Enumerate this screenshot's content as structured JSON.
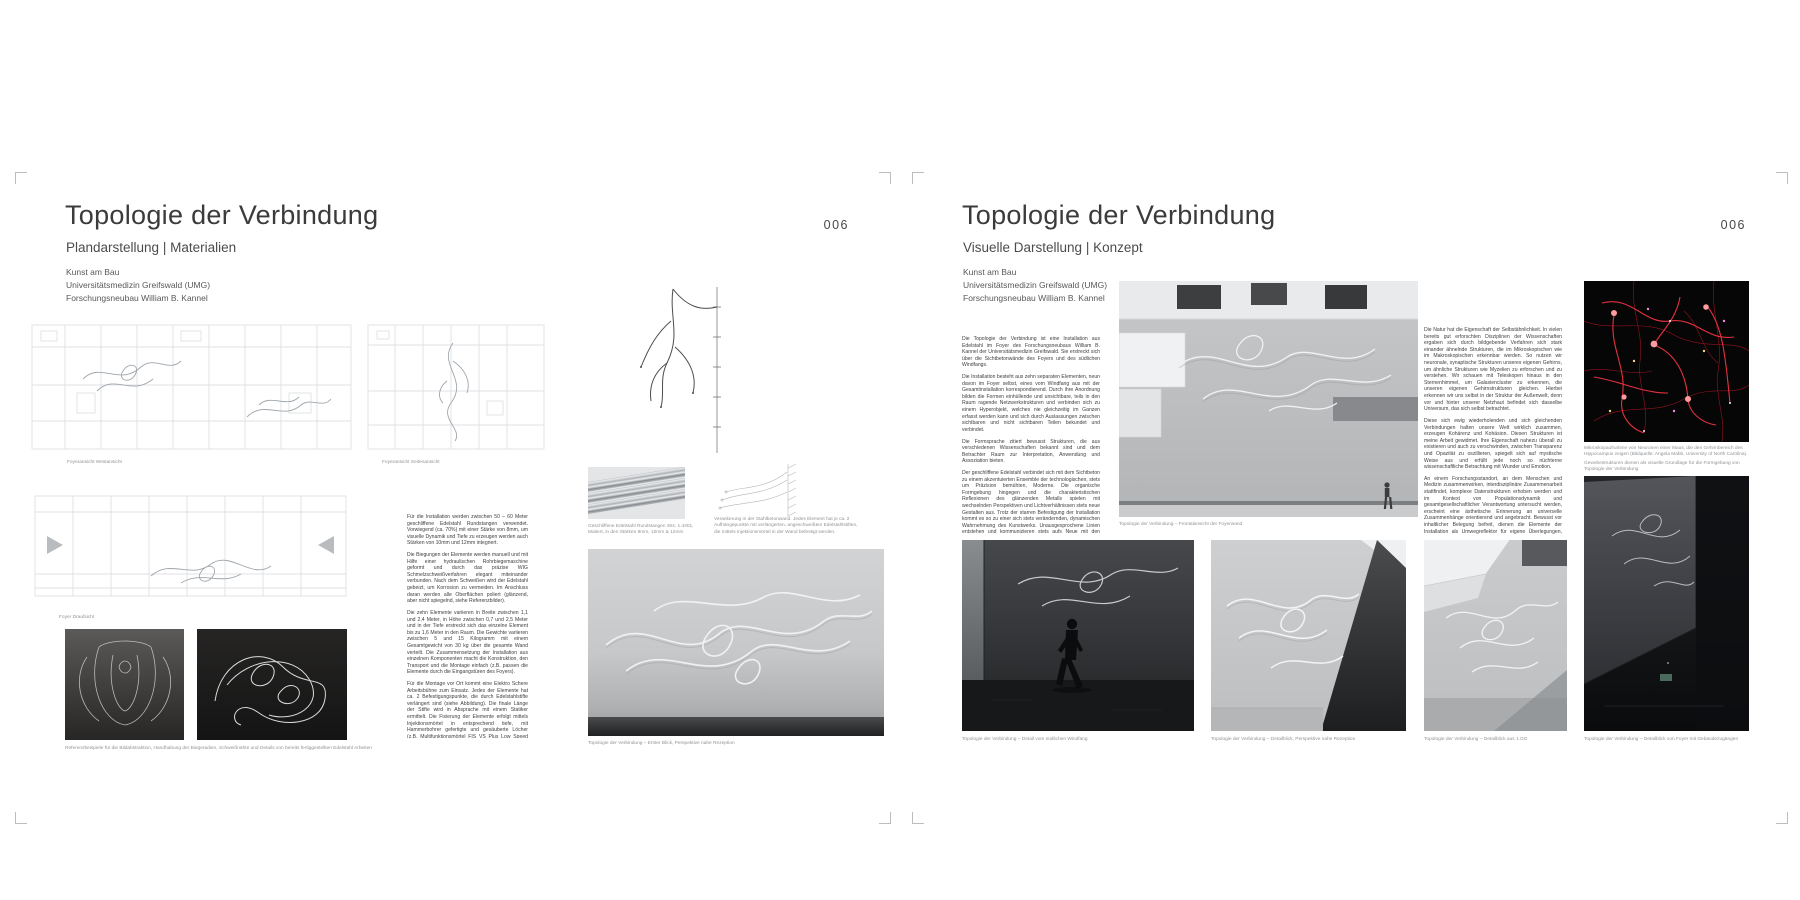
{
  "colors": {
    "paper": "#ffffff",
    "ink": "#3c3c3c",
    "caption_gray": "#909396",
    "neuron_red": "#ef3442"
  },
  "left_page": {
    "page_number": "006",
    "title": "Topologie der Verbindung",
    "subtitle": "Plandarstellung | Materialien",
    "credits": [
      "Kunst am Bau",
      "Universitätsmedizin Greifswald (UMG)",
      "Forschungsneubau William B. Kannel"
    ],
    "body": [
      "Für die Installation werden zwischen 50 – 60 Meter geschliffene Edelstahl Rundstangen verwendet. Vorwiegend (ca. 70%) mit einer Stärke von 8mm, um visuelle Dynamik und Tiefe zu erzeugen werden auch Stärken von 10mm und 12mm integriert.",
      "Die Biegungen der Elemente werden manuell und mit Hilfe einer hydraulischen Rohrbiegemaschine geformt und durch das präzise WIG Schmelzschweißverfahren elegant miteinander verbunden. Nach dem Schweißen wird der Edelstahl gebeizt, um Korrosion zu vermeiden. Im Anschluss daran werden alle Oberflächen poliert (glänzend, aber nicht spiegelnd, siehe Referenzbilder).",
      "Die zehn Elemente variieren in Breite zwischen 1,1 und 2,4 Meter, in Höhe zwischen 0,7 und 2,5 Meter und in der Tiefe erstreckt sich das einzelne Element bis zu 1,6 Meter in den Raum. Die Gewichte variieren zwischen 5 und 15 Kilogramm mit einem Gesamtgewicht von 30 kg über die gesamte Wand verteilt. Die Zusammensetzung der Installation aus einzelnen Komponenten macht die Konstruktion, den Transport und die Montage einfach (z.B. passen die Elemente durch die Eingangstüren des Foyers).",
      "Für die Montage vor Ort kommt eine Elektro Schere Arbeitsbühne zum Einsatz. Jedes der Elemente hat ca. 2 Befestigungspunkte, die durch Edelstahlstifte verlängert sind (siehe Abbildung). Die finale Länge der Stifte wird in Absprache mit einem Statiker ermittelt. Die Fixierung der Elemente erfolgt mittels Injektionsmörtel in entsprechend tiefe, mit Hammerbohrer gefertigte und gesäuberte Löcher (z.B. Multifunktionsmörtel FIS VS Plus Low Speed oder UPM 33).",
      "Edelstahl hat eine lange Lebensdauer und stellt keine Gefahr für Mensch und Umwelt dar. Eventuelle Folgekosten sollten nur aus gelegentlicher Grundreinigung entstehen. Eine gezielte Lichtinszenierung wäre denkbar, ist aber nicht zwingend erforderlich."
    ],
    "captions": {
      "plan_west": "Foyeransicht Westansicht",
      "plan_side": "Foyeransicht Seitenansicht",
      "plan_top": "Foyer Draufsicht",
      "rods": "Geschliffene Edelstahl Rundstangen 304, 1.4301, Matiert, in den Stärken 8mm, 10mm & 12mm",
      "anchor": "Verankerung in der Stahlbetonwand. Jedes Element hat je ca. 2 Aufhängepunkte mit verlängerten, angeschweißten Edelstahlstiften, die mittels Injektionsmörtel in der Wand befestigt werden.",
      "reference": "Referenzbeispiele für die Bildabstraktion, Handhabung der Biegeradien, Schweißnähte und Details von bereits fertiggestellten Edelstahl Arbeiten",
      "hero": "Topologie der Verbindung – Erster Blick, Perspektive nahe Rezeption"
    }
  },
  "right_page": {
    "page_number": "006",
    "title": "Topologie der Verbindung",
    "subtitle": "Visuelle Darstellung | Konzept",
    "credits": [
      "Kunst am Bau",
      "Universitätsmedizin Greifswald (UMG)",
      "Forschungsneubau William B. Kannel"
    ],
    "col1": [
      "Die Topologie der Verbindung ist eine Installation aus Edelstahl im Foyer des Forschungsneubaus William B. Kannel der Universitätsmedizin Greifswald. Sie erstreckt sich über die Sichtbetonwände des Foyers und des südlichen Windfangs.",
      "Die Installation besteht aus zehn separaten Elementen, neun davon im Foyer selbst, eines vom Windfang aus mit der Gesamtinstallation korrespondierend. Durch ihre Anordnung bilden die Formen einhüllende und unsichtbare, teils in den Raum ragende Netzwerkstrukturen und verbinden sich zu einem Hyperobjekt, welches nie gleichzeitig im Ganzen erfasst werden kann und sich durch Auslassungen zwischen sichtbaren und nicht sichtbaren Teilen bekundet und verbindet.",
      "Die Formsprache zitiert bewusst Strukturen, die aus verschiedenen Wissenschaften bekannt sind und dem Betrachter Raum zur Interpretation, Anwendung und Assoziation bieten.",
      "Der geschliffene Edelstahl verbindet sich mit dem Sichtbeton zu einem akzentuierten Ensemble der technologischen, stets um Präzision bemühten, Moderne. Die organische Formgebung hingegen und die charakteristischen Reflexionen des glänzenden Metalls spielen mit wechselnden Perspektiven und Lichtverhältnissen stets neue Gestalten aus. Trotz der starren Befestigung der Installation kommt es so zu einer sich stets verändernden, dynamischen Wahrnehmung des Kunstwerks. Unausgesprochene Linien entstehen und kommunizieren stets aufs Neue mit den wellenförmigen, zirkulären und triangulären Elementen der Installation, je nach Position im Raum."
    ],
    "col2": [
      "Die Natur hat die Eigenschaft der Selbstähnlichkeit. In vielen bereits gut erforschten Disziplinen der Wissenschaften ergaben sich durch bildgebende Verfahren sich stark einander ähnelnde Strukturen, die im Mikroskopischen wie im Makroskopischen erkennbar werden. So nutzen wir neuronale, synaptische Strukturen unseres eigenen Gehirns, um ähnliche Strukturen wie Myzelien zu erforschen und zu verstehen. Wir schauen mit Teleskopen hinaus in den Sternenhimmel, um Galaxiencluster zu erkennen, die unseren eigenen Gehirnstrukturen gleichen. Hierbei erkennen wir uns selbst in der Struktur der Außenwelt, denn vor und hinter unserer Netzhaut befindet sich dasselbe Universum, das sich selbst betrachtet.",
      "Diese sich ewig wiederholenden und sich gleichenden Verbindungen halten unsere Welt wirklich zusammen, erzeugen Kohärenz und Kohäsion. Diesen Strukturen ist meine Arbeit gewidmet. Ihre Eigenschaft nahezu überall zu existieren und auch zu verschwinden, zwischen Transparenz und Opazität zu oszillieren, spiegelt sich auf mystische Weise aus und erfüllt jede noch so nüchterne wissenschaftliche Betrachtung mit Wunder und Emotion.",
      "An einem Forschungsstandort, an dem Menschen und Medizin zusammenwirken, interdisziplinäre Zusammenarbeit stattfindet, komplexe Datenstrukturen erhoben werden und im Kontext von Populationsdynamik und gesamtgesellschaftlicher Verantwortung untersucht werden, erscheint eine ästhetische Erinnerung an universelle Zusammenhänge orientierend und angebracht. Bewusst vor inhaltlicher Belegung befreit, dienen die Elemente der Installation als Umwegreflektor für eigene Überlegungen, Ideen und die Verortung im jeweiligen Diskurs."
    ],
    "captions": {
      "main_render": "Topologie der Verbindung – Frontalansicht der Foyerwand",
      "neuron_line1": "Mikroskopaufnahme von Neuronen einer Maus, die den Gehirnbereich des Hippocampus zeigen (Bildquelle: Angela Mabb, University of North Carolina).",
      "neuron_line2": "Gewebestrukturen dienen als visuelle Grundlage für die Formgebung von Topologie der Verbindung",
      "windfang": "Topologie der Verbindung – Detail vom südlichen Windfang",
      "rezeption": "Topologie der Verbindung – Detailblick, Perspektive nahe Rezeption",
      "og": "Topologie der Verbindung – Detailblick aus 1.OG",
      "dark_render": "Topologie der Verbindung – Detailblick von Foyer mit Gebäudezugängen"
    }
  }
}
